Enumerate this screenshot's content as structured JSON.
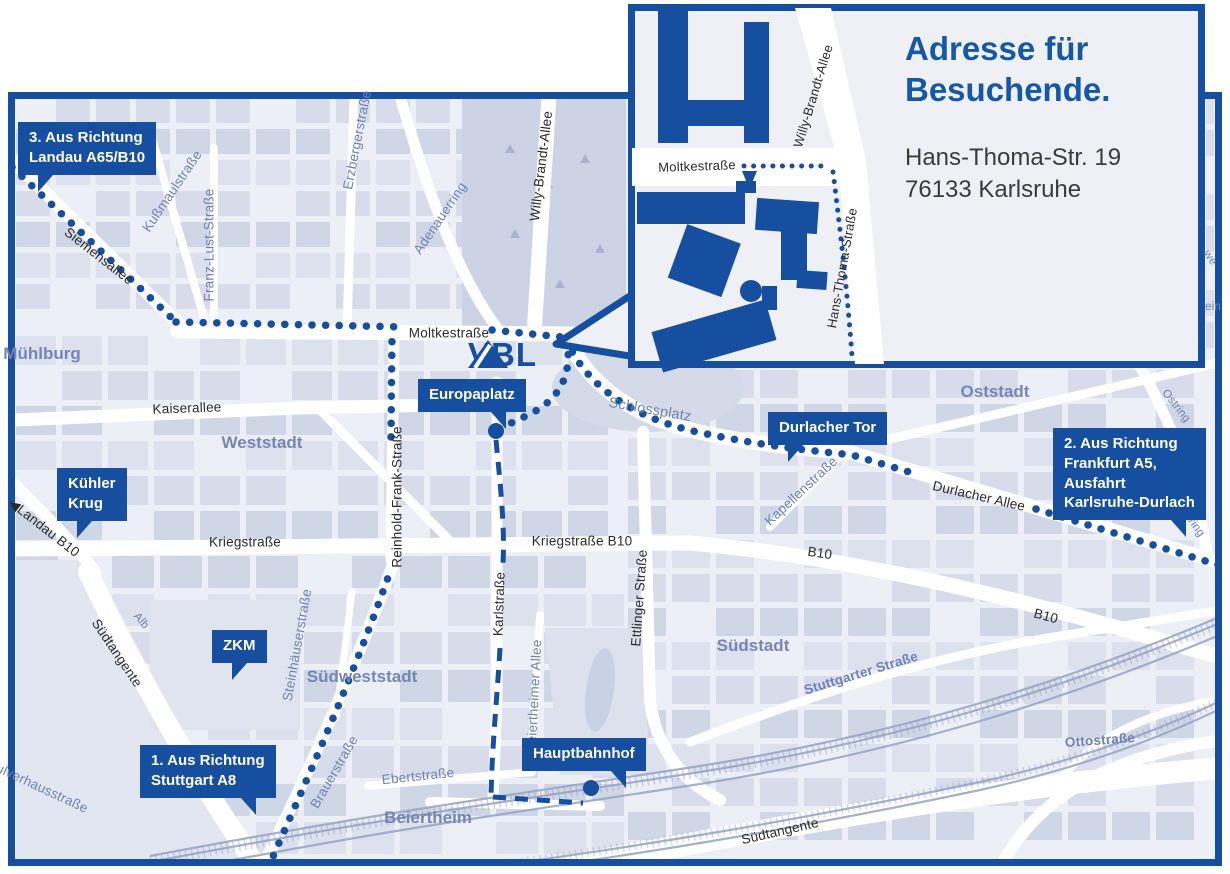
{
  "colors": {
    "brand": "#164f9f",
    "heading_blue": "#1558a8",
    "map_bg": "#edeff6",
    "block": "#d8dcea",
    "park": "#ccd3e4",
    "street": "#ffffff",
    "rail": "#96a3c5",
    "place_text": "#7486b8",
    "blue_street_text": "#6e82b5",
    "black_street_text": "#2b2b2b",
    "address_text": "#3b3b3b"
  },
  "logo": {
    "text": "VBL"
  },
  "inset": {
    "title_line1": "Adresse für",
    "title_line2": "Besuchende.",
    "address_line1": "Hans-Thoma-Str. 19",
    "address_line2": "76133 Karlsruhe",
    "street_labels": [
      {
        "text": "Moltkestraße",
        "x": 697,
        "y": 166,
        "rot": -2,
        "cls": "sm"
      },
      {
        "text": "Willy-Brandt-Allee",
        "x": 813,
        "y": 96,
        "rot": -73,
        "cls": "sm"
      },
      {
        "text": "Hans-Thoma-Straße",
        "x": 842,
        "y": 268,
        "rot": -80,
        "cls": "sm"
      }
    ]
  },
  "callouts": [
    {
      "id": "landau",
      "lines": [
        "3. Aus Richtung",
        "Landau A65/B10"
      ],
      "x": 18,
      "y": 122,
      "tail": "bl"
    },
    {
      "id": "frankfurt",
      "lines": [
        "2. Aus Richtung",
        "Frankfurt A5,",
        "Ausfahrt",
        "Karlsruhe-Durlach"
      ],
      "x": 1053,
      "y": 428,
      "tail": "br"
    },
    {
      "id": "stuttgart",
      "lines": [
        "1. Aus Richtung",
        "Stuttgart A8"
      ],
      "x": 140,
      "y": 745,
      "tail": "br"
    },
    {
      "id": "europaplatz",
      "lines": [
        "Europaplatz"
      ],
      "x": 418,
      "y": 379,
      "tail": "br"
    },
    {
      "id": "durlacher-tor",
      "lines": [
        "Durlacher Tor"
      ],
      "x": 768,
      "y": 412,
      "tail": "bl"
    },
    {
      "id": "kuehler-krug",
      "lines": [
        "Kühler",
        "Krug"
      ],
      "x": 57,
      "y": 468,
      "tail": "bl"
    },
    {
      "id": "zkm",
      "lines": [
        "ZKM"
      ],
      "x": 212,
      "y": 630,
      "tail": "bl"
    },
    {
      "id": "hauptbahnhof",
      "lines": [
        "Hauptbahnhof"
      ],
      "x": 522,
      "y": 738,
      "tail": "br"
    }
  ],
  "street_labels": [
    {
      "text": "Siemensallee",
      "x": 99,
      "y": 256,
      "rot": 38,
      "cls": ""
    },
    {
      "text": "Kußmaulstraße",
      "x": 172,
      "y": 191,
      "rot": -56,
      "cls": "blue"
    },
    {
      "text": "Franz-Lust-Straße",
      "x": 209,
      "y": 245,
      "rot": -90,
      "cls": "blue"
    },
    {
      "text": "Erzbergerstraße",
      "x": 357,
      "y": 140,
      "rot": -79,
      "cls": "blue"
    },
    {
      "text": "Adenauerring",
      "x": 440,
      "y": 218,
      "rot": -56,
      "cls": "blue"
    },
    {
      "text": "Willy-Brandt-Allee",
      "x": 541,
      "y": 166,
      "rot": -83,
      "cls": ""
    },
    {
      "text": "Moltkestraße",
      "x": 449,
      "y": 333,
      "rot": 0,
      "cls": ""
    },
    {
      "text": "Kaiserallee",
      "x": 187,
      "y": 408,
      "rot": -2,
      "cls": ""
    },
    {
      "text": "Schlossplatz",
      "x": 650,
      "y": 410,
      "rot": 10,
      "cls": "blue md"
    },
    {
      "text": "Durlacher Allee",
      "x": 979,
      "y": 496,
      "rot": 13,
      "cls": ""
    },
    {
      "text": "Kapellenstraße",
      "x": 801,
      "y": 491,
      "rot": -43,
      "cls": "blue"
    },
    {
      "text": "Ostring",
      "x": 1176,
      "y": 406,
      "rot": 52,
      "cls": "blue xs"
    },
    {
      "text": "Ostring",
      "x": 1191,
      "y": 520,
      "rot": 55,
      "cls": "blue xs"
    },
    {
      "text": "we",
      "x": 1210,
      "y": 258,
      "rot": 55,
      "cls": "blue xs"
    },
    {
      "text": "ein",
      "x": 1213,
      "y": 307,
      "rot": 0,
      "cls": "blue xs"
    },
    {
      "text": "◀Landau B10",
      "x": 44,
      "y": 528,
      "rot": 38,
      "cls": ""
    },
    {
      "text": "Kriegstraße",
      "x": 245,
      "y": 542,
      "rot": 0,
      "cls": ""
    },
    {
      "text": "Kriegstraße B10",
      "x": 582,
      "y": 541,
      "rot": 0,
      "cls": ""
    },
    {
      "text": "B10",
      "x": 820,
      "y": 553,
      "rot": 8,
      "cls": ""
    },
    {
      "text": "B10",
      "x": 1046,
      "y": 616,
      "rot": 15,
      "cls": ""
    },
    {
      "text": "Reinhold-Frank-Straße",
      "x": 397,
      "y": 497,
      "rot": -90,
      "cls": ""
    },
    {
      "text": "Karlstraße",
      "x": 499,
      "y": 604,
      "rot": -88,
      "cls": ""
    },
    {
      "text": "Ettlinger Straße",
      "x": 639,
      "y": 598,
      "rot": -86,
      "cls": ""
    },
    {
      "text": "Steinhäuserstraße",
      "x": 297,
      "y": 645,
      "rot": -80,
      "cls": "blue"
    },
    {
      "text": "Brauerstraße",
      "x": 334,
      "y": 772,
      "rot": -60,
      "cls": "blue"
    },
    {
      "text": "Ebertstraße",
      "x": 418,
      "y": 776,
      "rot": -6,
      "cls": "blue"
    },
    {
      "text": "Beiertheimer Allee",
      "x": 534,
      "y": 696,
      "rot": -87,
      "cls": "blue"
    },
    {
      "text": "Stuttgarter Straße",
      "x": 861,
      "y": 673,
      "rot": -17,
      "cls": "blue bold"
    },
    {
      "text": "Südtangente",
      "x": 780,
      "y": 831,
      "rot": -13,
      "cls": ""
    },
    {
      "text": "Südtangente",
      "x": 117,
      "y": 653,
      "rot": 56,
      "cls": ""
    },
    {
      "text": "Alb",
      "x": 141,
      "y": 621,
      "rot": 50,
      "cls": "blue xs"
    },
    {
      "text": "Pulverhausstraße",
      "x": 38,
      "y": 786,
      "rot": 25,
      "cls": "blue"
    },
    {
      "text": "Ottostraße",
      "x": 1100,
      "y": 740,
      "rot": -4,
      "cls": "blue bold"
    }
  ],
  "place_labels": [
    {
      "text": "Mühlburg",
      "x": 42,
      "y": 354
    },
    {
      "text": "Weststadt",
      "x": 262,
      "y": 443
    },
    {
      "text": "Oststadt",
      "x": 995,
      "y": 392
    },
    {
      "text": "Südweststadt",
      "x": 362,
      "y": 677
    },
    {
      "text": "Südstadt",
      "x": 753,
      "y": 646
    },
    {
      "text": "Beiertheim",
      "x": 428,
      "y": 818
    }
  ]
}
